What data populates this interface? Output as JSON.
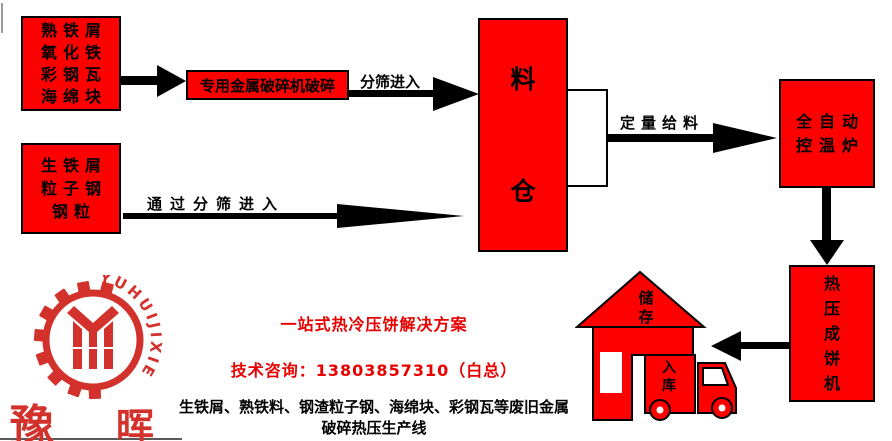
{
  "colors": {
    "flow_red": "#fe0000",
    "footer_red": "#e80000",
    "logo_red": "#d3312c",
    "outline": "#000000"
  },
  "flow": {
    "source_box_top": {
      "lines": [
        "熟铁屑",
        "氧化铁",
        "彩钢瓦",
        "海绵块"
      ]
    },
    "source_box_bottom": {
      "lines": [
        "生铁屑",
        "粒子钢",
        "钢粒"
      ]
    },
    "crusher_label": "专用金属破碎机破碎",
    "sieve_arrow_label": "分筛进入",
    "long_sieve_arrow_label": "通过分筛进入",
    "silo_char_top": "料",
    "silo_char_bottom": "仓",
    "feed_arrow_label": "定量给料",
    "furnace": {
      "lines": [
        "全自动",
        "控温炉"
      ]
    },
    "press_label": "热压成饼机",
    "storage_label": "储存",
    "warehouse_label": "入库"
  },
  "footer": {
    "slogan": "一站式热冷压饼解决方案",
    "contact": "技术咨询：13803857310（白总）",
    "description_line1": "生铁屑、熟铁料、钢渣粒子钢、海绵块、彩钢瓦等废旧金属",
    "description_line2": "破碎热压生产线"
  },
  "logo": {
    "curved_text": "YUHUIJIXIE",
    "name_left": "豫",
    "name_right": "晖"
  },
  "icons": {
    "storage": "house-icon",
    "warehouse": "truck-icon",
    "brand": "gear-monogram-icon"
  }
}
